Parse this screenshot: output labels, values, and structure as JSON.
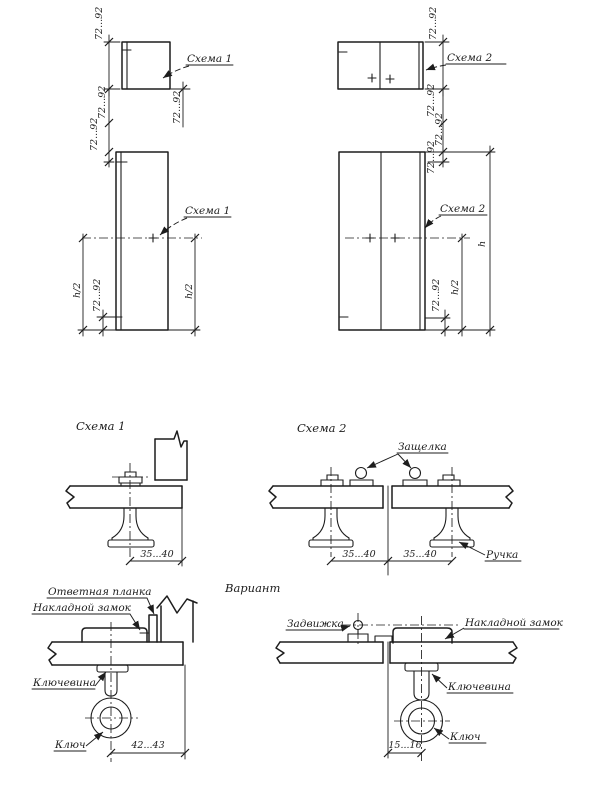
{
  "colors": {
    "ink": "#1d1d1d",
    "paper": "#ffffff"
  },
  "elev_left": {
    "dim_transom_height": "72...92",
    "callout_transom": "Схема 1",
    "dim_under_transom": "72...92",
    "dim_gap_upper": "72...92",
    "dim_gap_lower": "72...92",
    "callout_door": "Схема 1",
    "dim_half_left": "h/2",
    "dim_bottom_offset": "72...92",
    "dim_half_right": "h/2"
  },
  "elev_right": {
    "dim_transom_height": "72...92",
    "callout_transom": "Схема 2",
    "dim_gap_upper": "72...92",
    "dim_gap_lower": "72...92",
    "dim_door_top": "72...92",
    "callout_door": "Схема 2",
    "dim_half": "h/2",
    "dim_bottom_offset": "72...92",
    "dim_full_height": "h"
  },
  "detail_scheme1": {
    "title": "Схема 1",
    "dim_backset": "35...40"
  },
  "detail_scheme2": {
    "title": "Схема 2",
    "label_latch": "Защелка",
    "label_handle": "Ручка",
    "dim_left": "35...40",
    "dim_right": "35...40"
  },
  "variant": {
    "title": "Вариант"
  },
  "lock_front": {
    "label_strike_plate": "Ответная планка",
    "label_rim_lock": "Накладной замок",
    "label_keyhole": "Ключевина",
    "label_key": "Ключ",
    "dim_offset": "42...43"
  },
  "lock_variant": {
    "label_bolt": "Задвижка",
    "label_rim_lock": "Накладной замок",
    "label_keyhole": "Ключевина",
    "label_key": "Ключ",
    "dim_offset": "15...16"
  }
}
